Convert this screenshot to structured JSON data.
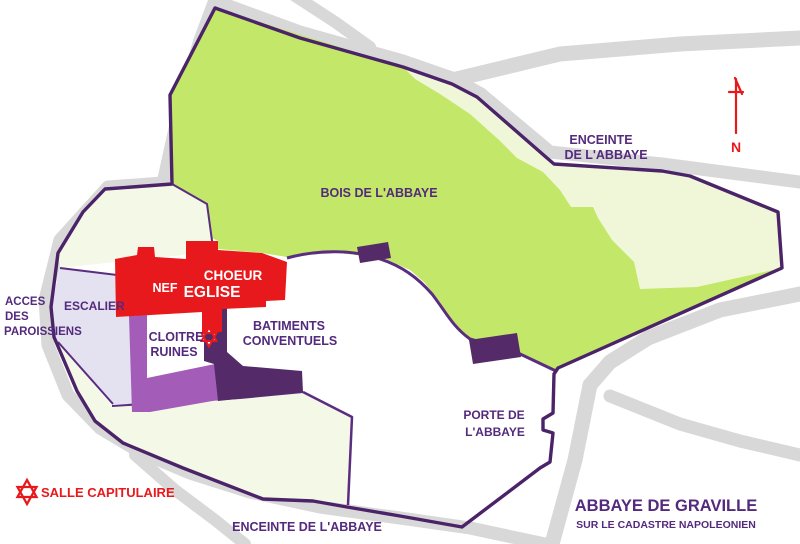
{
  "title": {
    "main": "ABBAYE DE GRAVILLE",
    "subtitle": "SUR LE CADASTRE NAPOLEONIEN"
  },
  "compass": {
    "label": "N"
  },
  "legend": {
    "star_label": "SALLE CAPITULAIRE"
  },
  "labels": {
    "woods": "BOIS DE L'ABBAYE",
    "enceinte_top_line1": "ENCEINTE",
    "enceinte_top_line2": "DE L'ABBAYE",
    "enceinte_bottom": "ENCEINTE DE L'ABBAYE",
    "acces_line1": "ACCES",
    "acces_line2": "DES",
    "acces_line3": "PAROISSIENS",
    "escalier": "ESCALIER",
    "cloitre_line1": "CLOITRE",
    "cloitre_line2": "RUINES",
    "batiments_line1": "BATIMENTS",
    "batiments_line2": "CONVENTUELS",
    "porte_line1": "PORTE DE",
    "porte_line2": "L'ABBAYE",
    "nef": "NEF",
    "eglise": "EGLISE",
    "choeur": "CHOEUR"
  },
  "colors": {
    "woods_green": "#c3e768",
    "clearing_pale_green": "#f0f7d8",
    "parcel_cream": "#f4f8e6",
    "parcel_lavender": "#e4e1f0",
    "cloister_violet": "#a35cb8",
    "building_dark_purple": "#542a68",
    "church_red": "#e8191c",
    "road_gray": "#d8d8d8",
    "wall_purple": "#4b2368",
    "label_purple": "#542a7d",
    "legend_red": "#e8191c",
    "background": "#ffffff"
  }
}
